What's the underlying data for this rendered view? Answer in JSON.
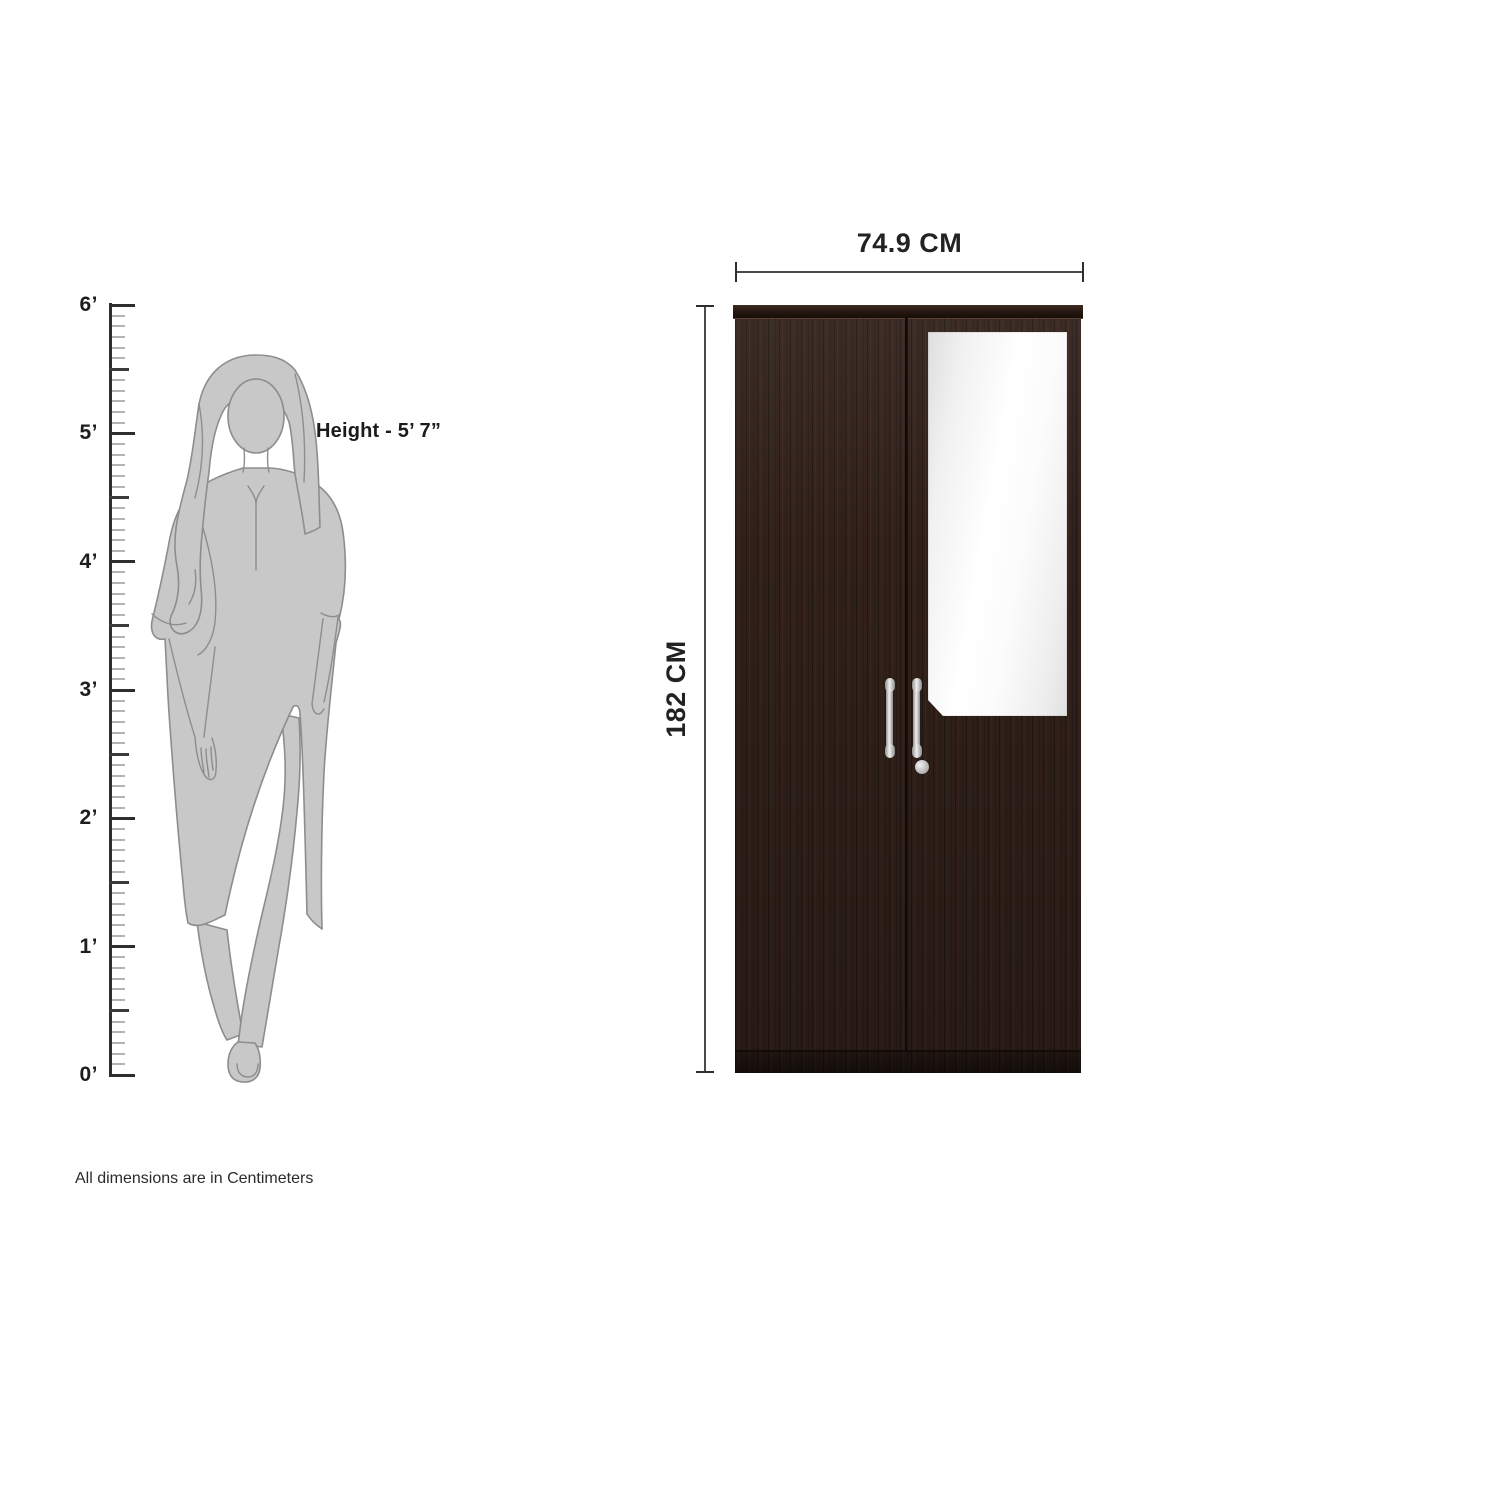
{
  "ruler": {
    "labels": [
      "6’",
      "5’",
      "4’",
      "3’",
      "2’",
      "1’",
      "0’"
    ]
  },
  "person": {
    "height_label": "Height - 5’ 7”"
  },
  "wardrobe": {
    "width_label": "74.9 CM",
    "height_label": "182 CM"
  },
  "footer": {
    "note": "All dimensions are in Centimeters"
  },
  "colors": {
    "wood": "#31211a",
    "wood_cap": "#241710",
    "mirror": "#ffffff",
    "handle_silver": "#d6d6d6",
    "silhouette_gray": "#c8c8c8",
    "dimension_line": "#4a4a4a"
  }
}
